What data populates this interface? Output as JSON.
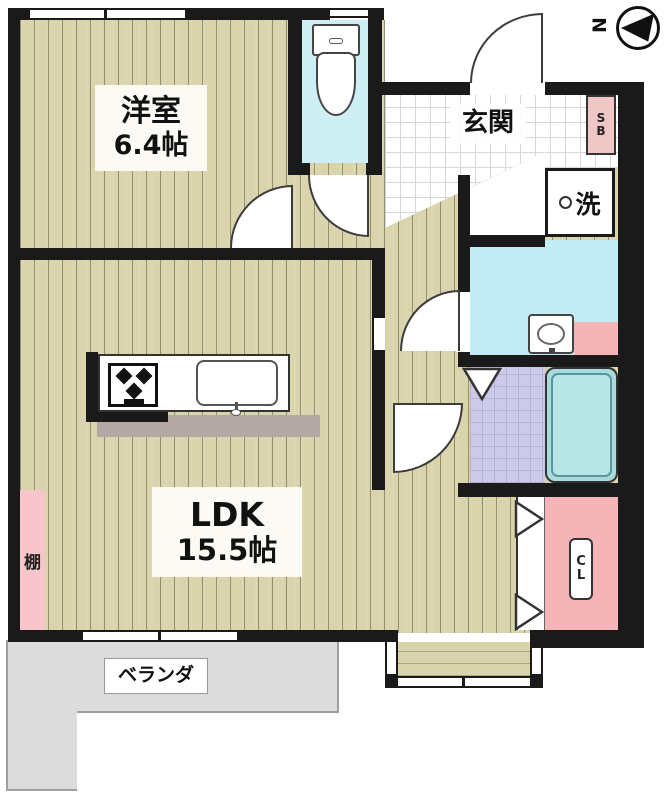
{
  "floorplan": {
    "compass": {
      "north": "N"
    },
    "rooms": {
      "bedroom": {
        "name": "洋室",
        "area": "6.4帖"
      },
      "ldk": {
        "name": "LDK",
        "area": "15.5帖"
      },
      "entrance": {
        "name": "玄関"
      },
      "shoe_box": {
        "line1": "S",
        "line2": "B"
      },
      "laundry": {
        "name": "洗"
      },
      "shelf": {
        "name": "棚"
      },
      "closet": {
        "line1": "C",
        "line2": "L"
      },
      "veranda": {
        "name": "ベランダ"
      }
    },
    "colors": {
      "wood_floor": "#d9d4ac",
      "wall": "#1a1a1a",
      "toilet_floor": "#cdeef2",
      "washroom_floor": "#c2ecf4",
      "bathroom_floor": "#ccc9ea",
      "bathtub": "#a8dcdc",
      "closet_pink": "#f5b4b8",
      "shelf_pink": "#f8c6ca",
      "shoebox_pink": "#efc6c6",
      "veranda_gray": "#dcdcdc",
      "counter_gray": "#b3a8a4"
    }
  }
}
